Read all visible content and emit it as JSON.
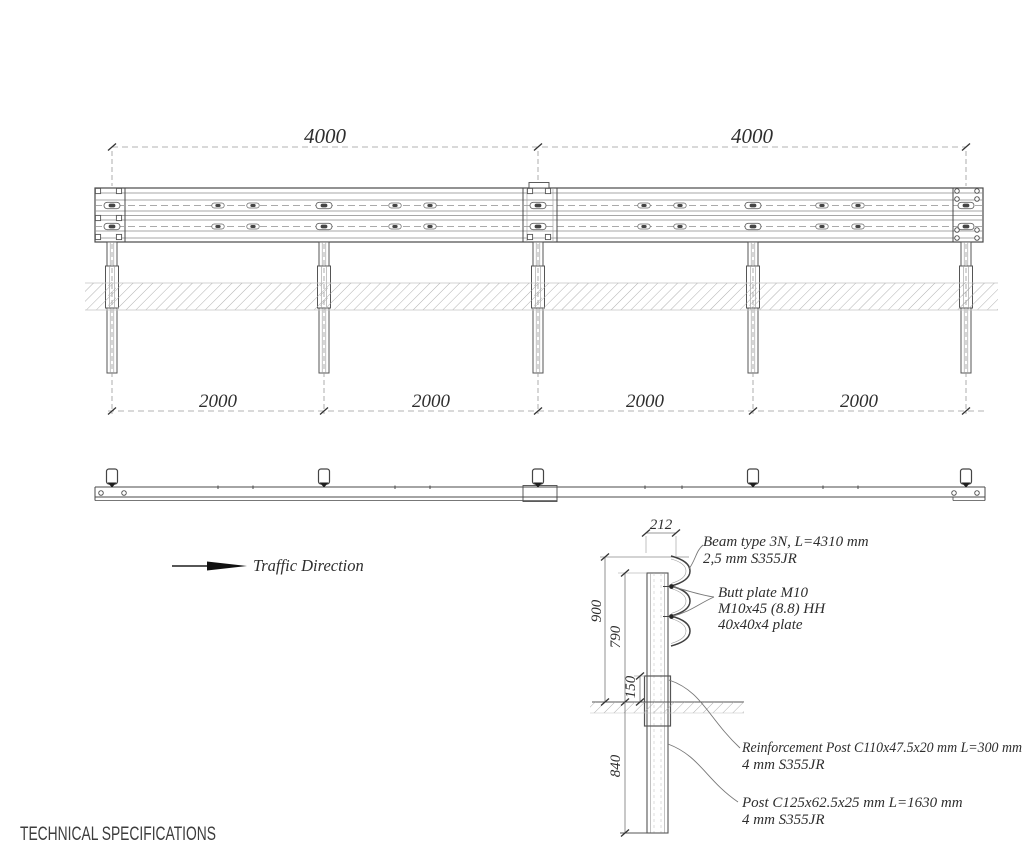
{
  "title": "TECHNICAL SPECIFICATIONS",
  "labels": {
    "traffic_direction": "Traffic Direction"
  },
  "elevation": {
    "top_dims": [
      "4000",
      "4000"
    ],
    "bottom_dims": [
      "2000",
      "2000",
      "2000",
      "2000"
    ]
  },
  "detail": {
    "dim_212": "212",
    "dim_900": "900",
    "dim_790": "790",
    "dim_150": "150",
    "dim_840": "840",
    "beam_note": [
      "Beam type 3N, L=4310 mm",
      "2,5 mm S355JR"
    ],
    "butt_note": [
      "Butt plate M10",
      "M10x45 (8.8) HH",
      "40x40x4 plate"
    ],
    "reinforcement_note": [
      "Reinforcement Post C110x47.5x20 mm L=300 mm",
      "4 mm S355JR"
    ],
    "post_note": [
      "Post C125x62.5x25 mm L=1630 mm",
      "4 mm S355JR"
    ]
  },
  "colors": {
    "line": "#4a4a4a",
    "dim_line": "#9a9a9a",
    "hatch": "#a8a8a8",
    "text": "#2e2e2e"
  }
}
